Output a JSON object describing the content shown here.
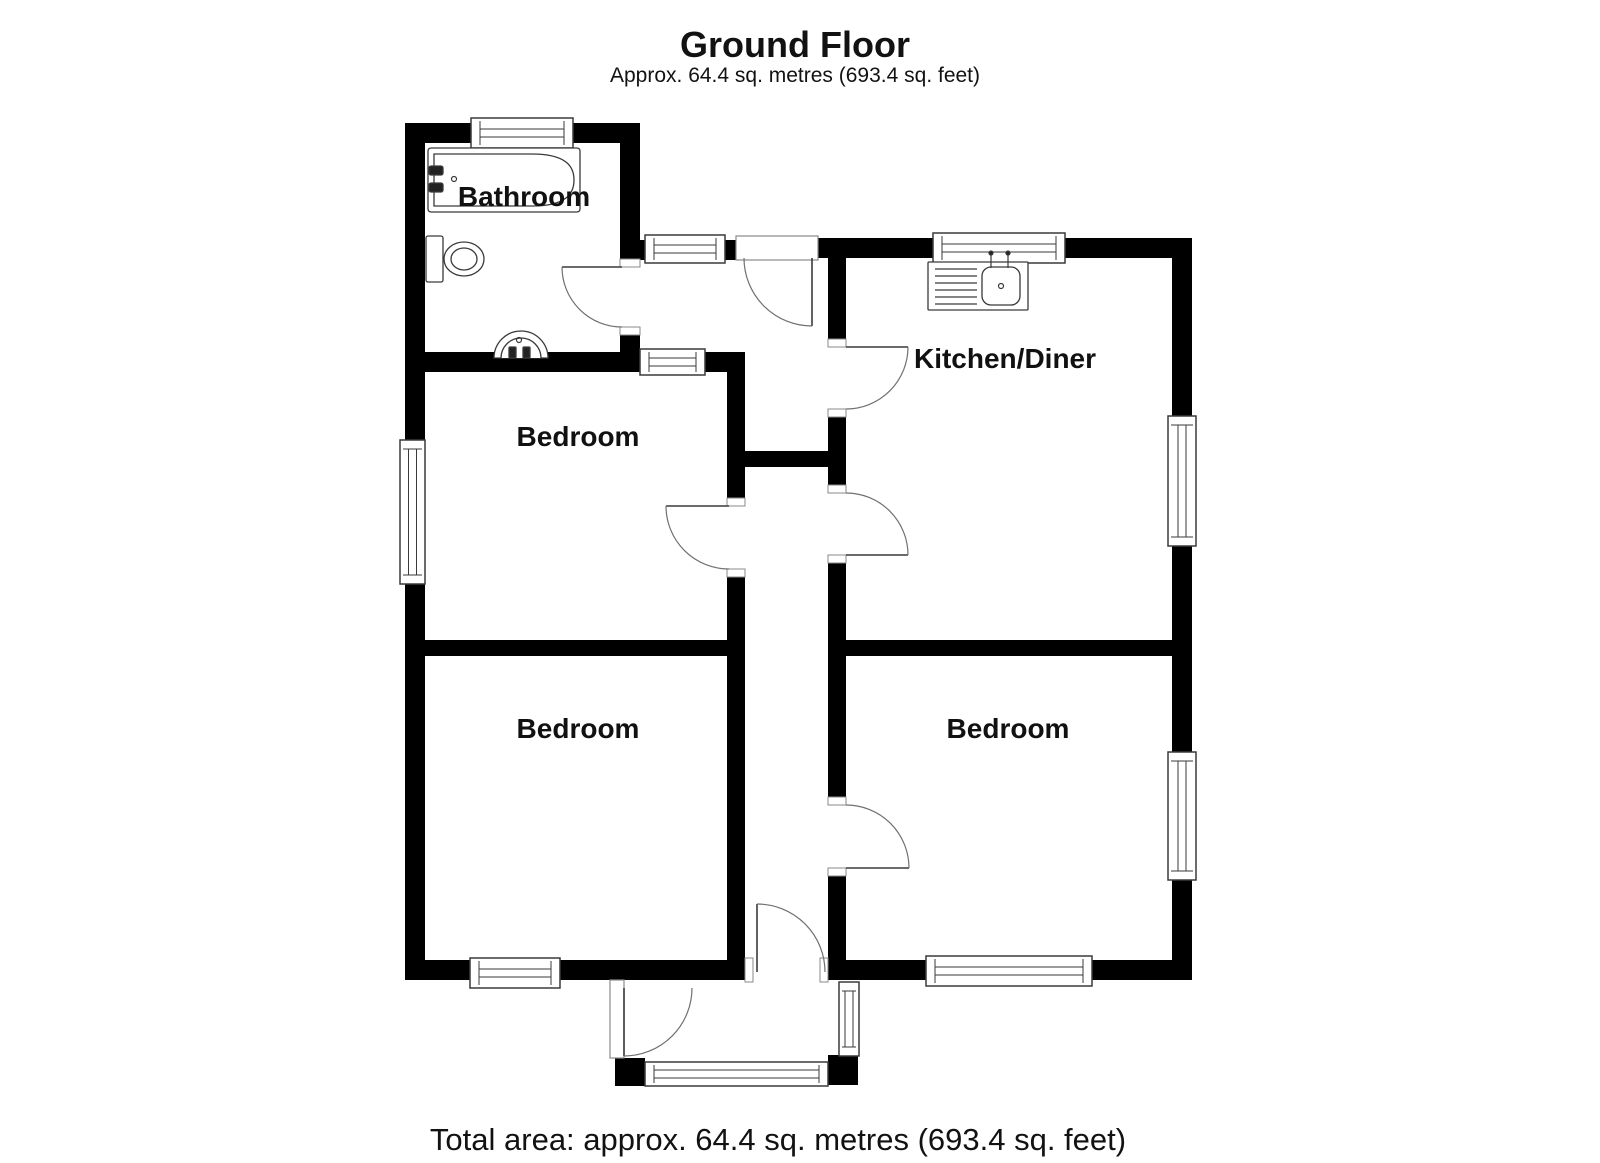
{
  "title": "Ground Floor",
  "subtitle": "Approx. 64.4 sq. metres (693.4 sq. feet)",
  "footer": "Total area: approx. 64.4 sq. metres (693.4 sq. feet)",
  "colors": {
    "wall": "#000000",
    "bg": "#ffffff",
    "line": "#3a3a3a",
    "arc": "#707070",
    "frame": "#8a8a8a",
    "text": "#111111"
  },
  "rooms": [
    {
      "label": "Bathroom",
      "x": 524,
      "y": 206
    },
    {
      "label": "Kitchen/Diner",
      "x": 1005,
      "y": 368
    },
    {
      "label": "Bedroom",
      "x": 578,
      "y": 446
    },
    {
      "label": "Bedroom",
      "x": 578,
      "y": 738
    },
    {
      "label": "Bedroom",
      "x": 1008,
      "y": 738
    }
  ],
  "plan": {
    "walls": [
      [
        405,
        123,
        235,
        20
      ],
      [
        405,
        123,
        20,
        857
      ],
      [
        620,
        123,
        20,
        144
      ],
      [
        620,
        327,
        20,
        45
      ],
      [
        405,
        352,
        340,
        20
      ],
      [
        640,
        240,
        105,
        20
      ],
      [
        818,
        238,
        374,
        20
      ],
      [
        1172,
        238,
        20,
        742
      ],
      [
        405,
        960,
        787,
        20
      ],
      [
        727,
        352,
        18,
        154
      ],
      [
        727,
        569,
        18,
        411
      ],
      [
        405,
        640,
        340,
        16
      ],
      [
        828,
        258,
        18,
        89
      ],
      [
        828,
        409,
        18,
        84
      ],
      [
        828,
        555,
        18,
        250
      ],
      [
        828,
        868,
        18,
        112
      ],
      [
        745,
        451,
        83,
        16
      ],
      [
        828,
        640,
        364,
        16
      ],
      [
        615,
        1058,
        30,
        28
      ],
      [
        828,
        1055,
        30,
        30
      ]
    ],
    "gaps": [
      [
        745,
        958,
        83,
        24
      ]
    ],
    "frames": [
      [
        736,
        236,
        82,
        24
      ],
      [
        610,
        980,
        14,
        78
      ]
    ],
    "caps": [
      [
        620,
        259,
        20,
        8
      ],
      [
        620,
        327,
        20,
        8
      ],
      [
        828,
        339,
        18,
        8
      ],
      [
        828,
        409,
        18,
        8
      ],
      [
        828,
        485,
        18,
        8
      ],
      [
        828,
        555,
        18,
        8
      ],
      [
        727,
        498,
        18,
        8
      ],
      [
        727,
        569,
        18,
        8
      ],
      [
        828,
        797,
        18,
        8
      ],
      [
        828,
        868,
        18,
        8
      ],
      [
        745,
        958,
        8,
        24
      ],
      [
        820,
        958,
        8,
        24
      ]
    ],
    "windows": [
      {
        "name": "bathroom-window",
        "x": 471,
        "y": 118,
        "w": 102,
        "h": 30,
        "o": "h"
      },
      {
        "name": "hall-top-window",
        "x": 645,
        "y": 235,
        "w": 80,
        "h": 28,
        "o": "h"
      },
      {
        "name": "internal-hall-window",
        "x": 640,
        "y": 349,
        "w": 65,
        "h": 26,
        "o": "h"
      },
      {
        "name": "kitchen-top-window",
        "x": 933,
        "y": 233,
        "w": 132,
        "h": 30,
        "o": "h"
      },
      {
        "name": "kitchen-right-window",
        "x": 1168,
        "y": 416,
        "w": 28,
        "h": 130,
        "o": "v"
      },
      {
        "name": "bedroom-left-window",
        "x": 400,
        "y": 440,
        "w": 25,
        "h": 144,
        "o": "v"
      },
      {
        "name": "bedroom-right-side-window",
        "x": 1168,
        "y": 752,
        "w": 28,
        "h": 128,
        "o": "v"
      },
      {
        "name": "bedroom-left-bottom-window",
        "x": 470,
        "y": 958,
        "w": 90,
        "h": 30,
        "o": "h"
      },
      {
        "name": "bedroom-right-bottom-window",
        "x": 926,
        "y": 956,
        "w": 166,
        "h": 30,
        "o": "h"
      },
      {
        "name": "porch-bottom-window",
        "x": 645,
        "y": 1062,
        "w": 183,
        "h": 24,
        "o": "h"
      },
      {
        "name": "porch-side-window",
        "x": 839,
        "y": 982,
        "w": 20,
        "h": 74,
        "o": "v"
      }
    ],
    "doors": [
      {
        "name": "bathroom-door",
        "leaf": [
          622,
          267,
          562,
          267
        ],
        "arc": "M 562 267 A 60 60 0 0 0 622 327"
      },
      {
        "name": "rear-entrance-door",
        "leaf": [
          812,
          258,
          812,
          326
        ],
        "arc": "M 744 258 A 68 68 0 0 0 812 326"
      },
      {
        "name": "kitchen-door-upper",
        "leaf": [
          846,
          347,
          908,
          347
        ],
        "arc": "M 908 347 A 62 62 0 0 1 846 409"
      },
      {
        "name": "kitchen-door-lower",
        "leaf": [
          846,
          555,
          908,
          555
        ],
        "arc": "M 846 493 A 62 62 0 0 1 908 555"
      },
      {
        "name": "bedroom-middle-door",
        "leaf": [
          729,
          506,
          666,
          506
        ],
        "arc": "M 666 506 A 63 63 0 0 0 729 569"
      },
      {
        "name": "bedroom-right-door",
        "leaf": [
          846,
          868,
          909,
          868
        ],
        "arc": "M 846 805 A 63 63 0 0 1 909 868"
      },
      {
        "name": "hall-porch-door",
        "leaf": [
          757,
          972,
          757,
          904
        ],
        "arc": "M 757 904 A 68 68 0 0 1 825 972"
      },
      {
        "name": "porch-entrance-door",
        "leaf": [
          624,
          988,
          624,
          1056
        ],
        "arc": "M 624 1056 A 68 68 0 0 0 692 988"
      }
    ],
    "fixtures": [
      {
        "name": "bath",
        "shapes": [
          {
            "k": "rect",
            "a": [
              428,
              148,
              152,
              64,
              3
            ]
          },
          {
            "k": "path",
            "a": [
              "M 434 154 H 532 C 567 154 574 167 574 180 C 574 193 567 206 532 206 H 434 Z"
            ]
          },
          {
            "k": "rect",
            "a": [
              429,
              166,
              14,
              9,
              2
            ],
            "f": 1
          },
          {
            "k": "rect",
            "a": [
              429,
              183,
              14,
              9,
              2
            ],
            "f": 1
          },
          {
            "k": "circle",
            "a": [
              454,
              179,
              2.5
            ]
          }
        ]
      },
      {
        "name": "toilet",
        "shapes": [
          {
            "k": "rect",
            "a": [
              426,
              236,
              17,
              46,
              2
            ]
          },
          {
            "k": "ellipse",
            "a": [
              464,
              259,
              20,
              17
            ]
          },
          {
            "k": "ellipse",
            "a": [
              464,
              259,
              13,
              11
            ]
          }
        ]
      },
      {
        "name": "hand-basin",
        "shapes": [
          {
            "k": "path",
            "a": [
              "M 494 358 A 27 27 0 0 1 548 358 Z"
            ]
          },
          {
            "k": "path",
            "a": [
              "M 501 358 A 20 20 0 0 1 541 358"
            ]
          },
          {
            "k": "rect",
            "a": [
              509,
              347,
              7,
              11,
              1
            ],
            "f": 1
          },
          {
            "k": "rect",
            "a": [
              523,
              347,
              7,
              11,
              1
            ],
            "f": 1
          },
          {
            "k": "circle",
            "a": [
              519,
              340,
              2.5
            ]
          }
        ]
      },
      {
        "name": "kitchen-sink",
        "shapes": [
          {
            "k": "rect",
            "a": [
              928,
              262,
              100,
              48,
              1
            ]
          },
          {
            "k": "line",
            "a": [
              935,
              269,
              977,
              269
            ]
          },
          {
            "k": "line",
            "a": [
              935,
              276,
              977,
              276
            ]
          },
          {
            "k": "line",
            "a": [
              935,
              283,
              977,
              283
            ]
          },
          {
            "k": "line",
            "a": [
              935,
              290,
              977,
              290
            ]
          },
          {
            "k": "line",
            "a": [
              935,
              297,
              977,
              297
            ]
          },
          {
            "k": "line",
            "a": [
              935,
              304,
              977,
              304
            ]
          },
          {
            "k": "rect",
            "a": [
              982,
              267,
              38,
              38,
              9
            ]
          },
          {
            "k": "circle",
            "a": [
              1001,
              286,
              2.5
            ]
          },
          {
            "k": "line",
            "a": [
              991,
              254,
              991,
              268
            ]
          },
          {
            "k": "line",
            "a": [
              1008,
              254,
              1008,
              268
            ]
          },
          {
            "k": "circle",
            "a": [
              991,
              253,
              2
            ],
            "f": 1
          },
          {
            "k": "circle",
            "a": [
              1008,
              253,
              2
            ],
            "f": 1
          }
        ]
      }
    ]
  }
}
